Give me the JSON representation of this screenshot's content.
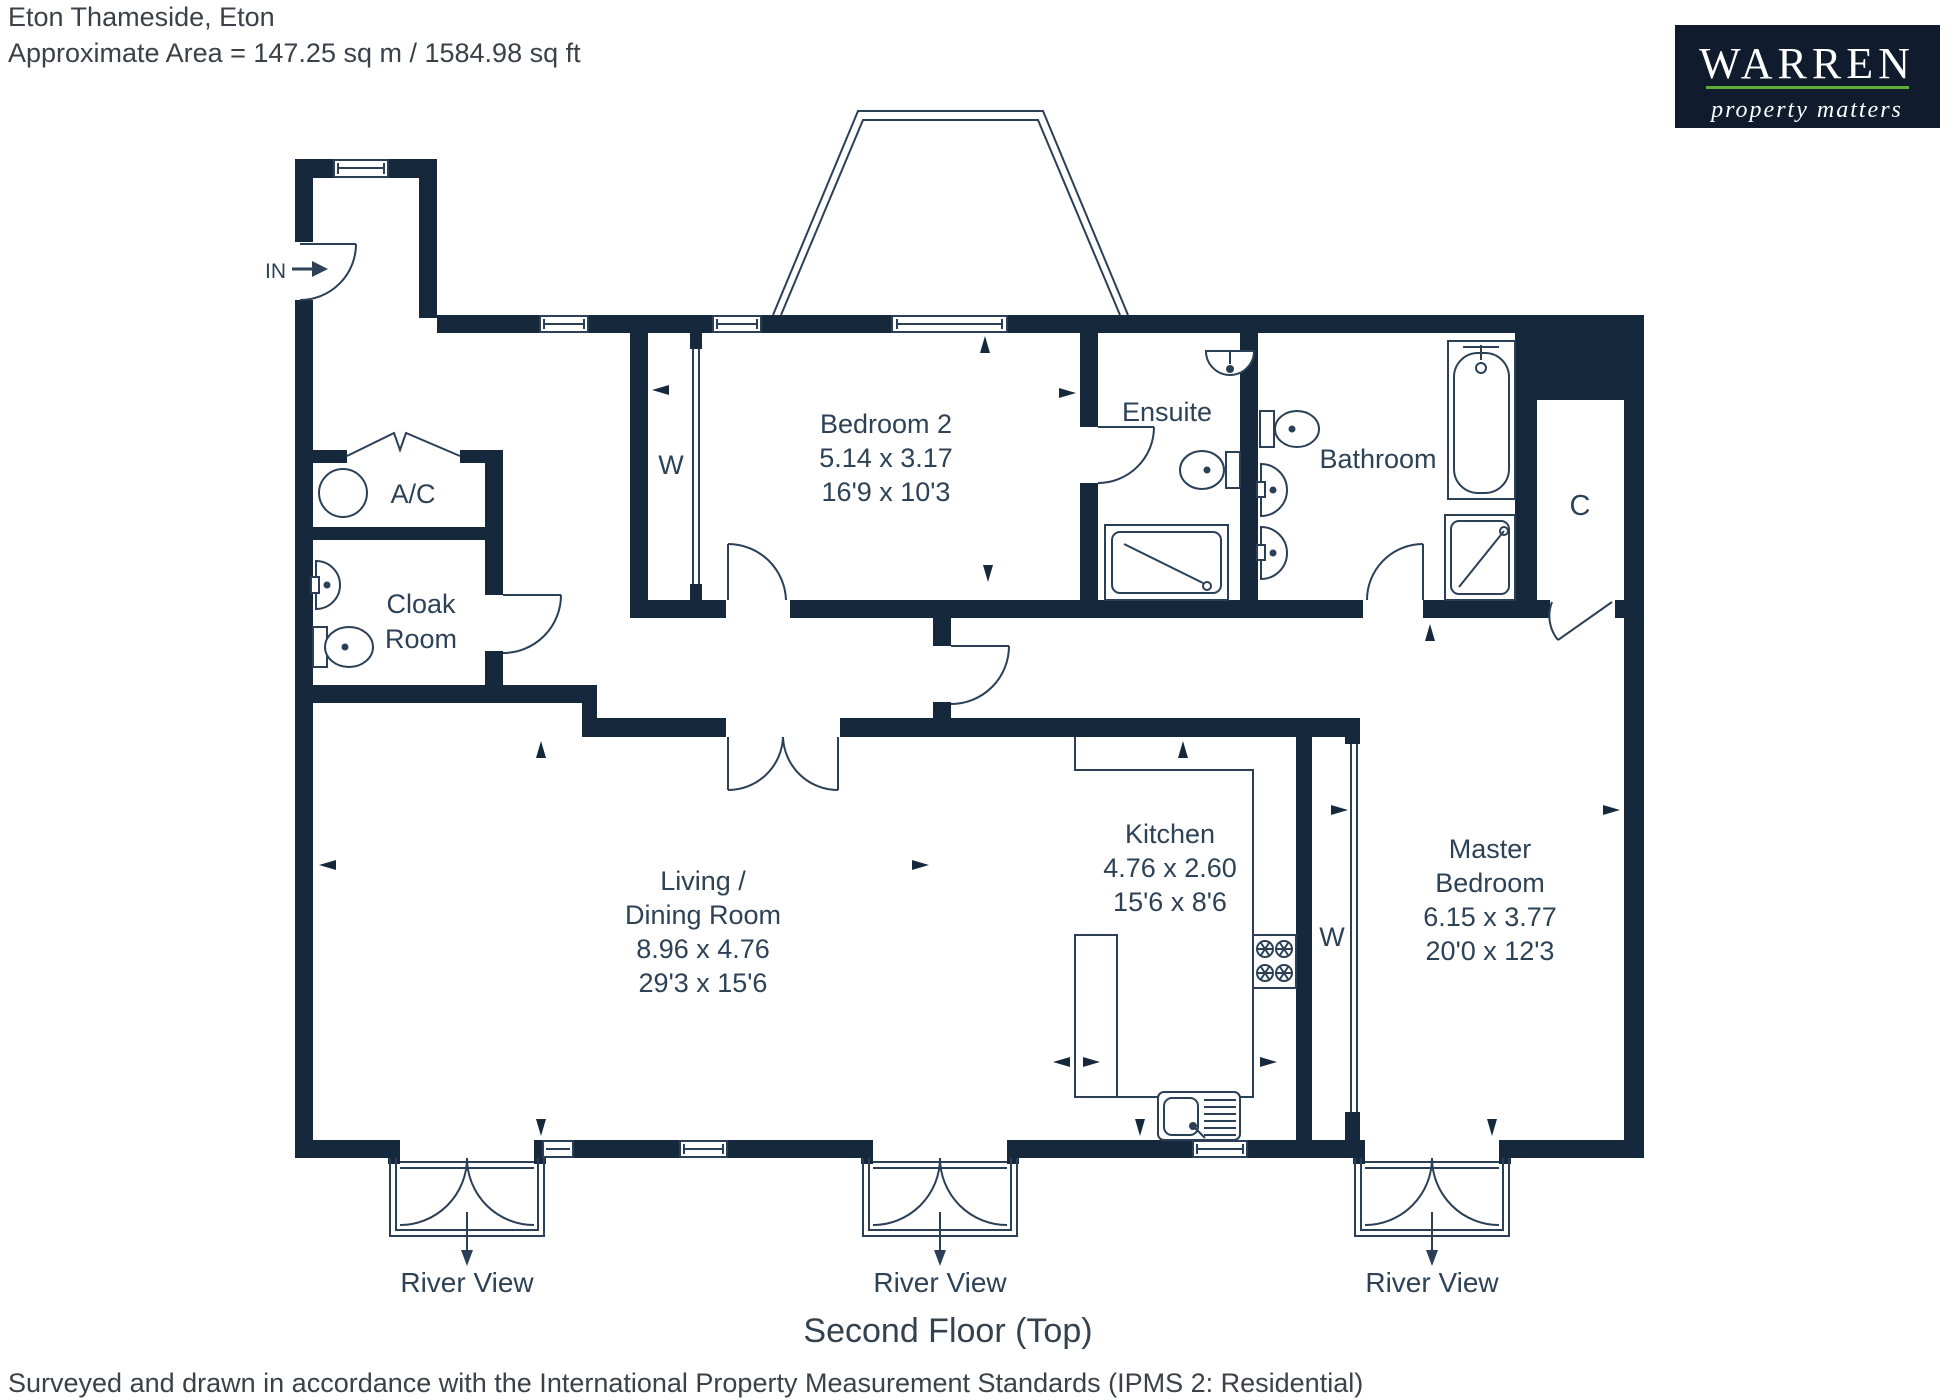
{
  "header": {
    "address": "Eton Thameside, Eton",
    "area": "Approximate Area = 147.25 sq m / 1584.98 sq ft"
  },
  "logo": {
    "brand": "WARREN",
    "tagline": "property matters",
    "bg_color": "#101b2e",
    "accent_color": "#5fae3a"
  },
  "plan": {
    "floor_title": "Second Floor (Top)",
    "entrance_label": "IN",
    "wardrobe_label": "W",
    "river_view_label": "River View",
    "rooms": [
      {
        "name": "Bedroom 2",
        "dims_m": "5.14 x 3.17",
        "dims_ft": "16'9 x 10'3"
      },
      {
        "name": "Ensuite"
      },
      {
        "name": "Bathroom"
      },
      {
        "name": "C"
      },
      {
        "name": "A/C"
      },
      {
        "name": "Cloak",
        "name2": "Room"
      },
      {
        "name": "Living /",
        "name2": "Dining Room",
        "dims_m": "8.96 x 4.76",
        "dims_ft": "29'3 x 15'6"
      },
      {
        "name": "Kitchen",
        "dims_m": "4.76 x 2.60",
        "dims_ft": "15'6 x 8'6"
      },
      {
        "name": "Master",
        "name2": "Bedroom",
        "dims_m": "6.15 x 3.77",
        "dims_ft": "20'0 x 12'3"
      }
    ],
    "colors": {
      "wall": "#16293c",
      "line": "#2b4057",
      "text": "#2d4256"
    }
  },
  "footer": {
    "note": "Surveyed and drawn in accordance with the International Property Measurement Standards (IPMS 2: Residential)"
  }
}
